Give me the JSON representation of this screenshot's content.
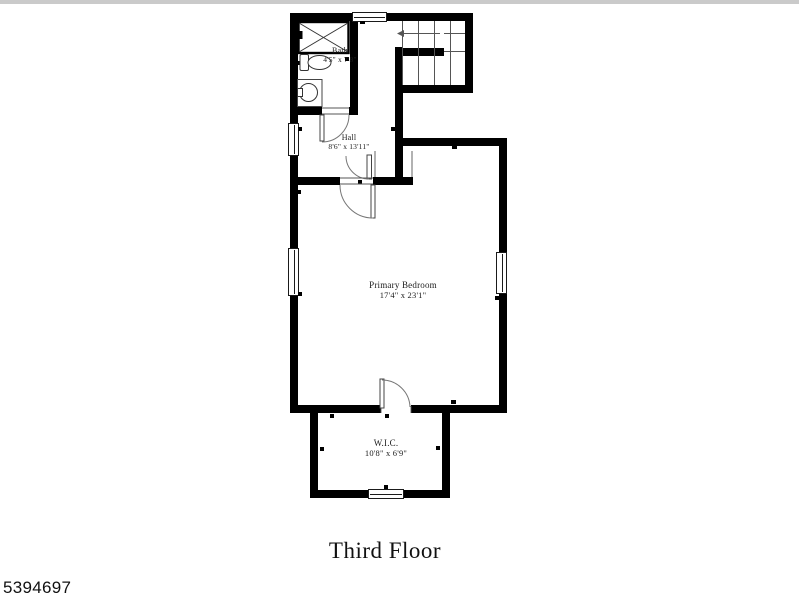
{
  "page": {
    "background_color": "#ffffff",
    "top_strip_color": "#cacaca"
  },
  "plan": {
    "wall_color": "#000000",
    "thin_line_color": "#555555",
    "rooms": [
      {
        "id": "bath",
        "name": "Bath",
        "dimensions": "4'5\" x 7'8\""
      },
      {
        "id": "hall",
        "name": "Hall",
        "dimensions": "8'6\" x 13'11\""
      },
      {
        "id": "primary-bedroom",
        "name": "Primary Bedroom",
        "dimensions": "17'4\" x 23'1\""
      },
      {
        "id": "wic",
        "name": "W.I.C.",
        "dimensions": "10'8\" x 6'9\""
      }
    ],
    "fixtures": [
      "staircase",
      "shower",
      "toilet",
      "sink",
      "doors",
      "windows"
    ]
  },
  "title": "Third Floor",
  "listing_id": "5394697"
}
